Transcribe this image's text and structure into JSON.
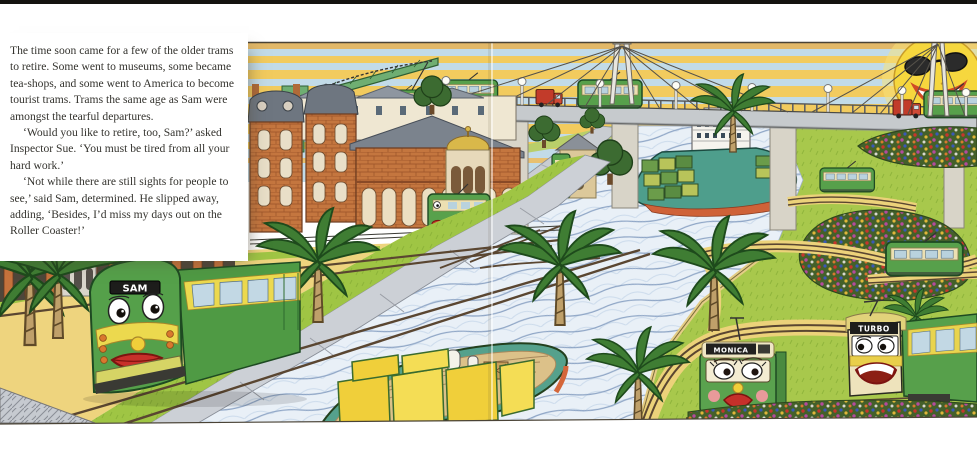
{
  "story": {
    "paragraphs": [
      "The time soon came for a few of the older trams to retire. Some went to museums, some became tea-shops, and some went to America to become tourist trams. Trams the same age as Sam were amongst the tearful departures.",
      "‘Would you like to retire, too, Sam?’ asked Inspector Sue. ‘You must be tired from all your hard work.’",
      "‘Not while there are still sights for people to see,’ said Sam, determined. He slipped away, adding, ‘Besides, I’d miss my days out on the Roller Coaster!’"
    ]
  },
  "illustration": {
    "boards": {
      "sam": "SAM",
      "monica": "MONICA",
      "turbo": "TURBO"
    },
    "colors": {
      "tram_green": "#57a04b",
      "tram_cream": "#ece0b2",
      "lips_red": "#c8302a",
      "sky_blue": "#c2dbe8",
      "ray_yellow": "#f2cb5e",
      "sun_yellow": "#f6d73e",
      "water_blue": "#e9f0f7",
      "grass_green": "#a8c84c",
      "paving_sand": "#eed47e",
      "brick_red": "#c4763f",
      "ship_teal": "#4e9e8c",
      "barge_yellow": "#f0cf3a"
    }
  }
}
